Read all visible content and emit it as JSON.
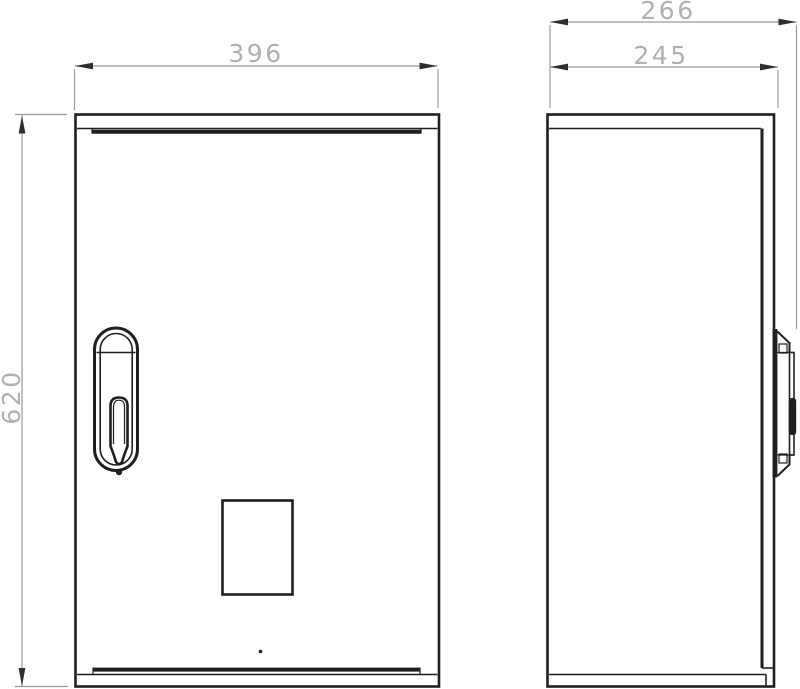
{
  "drawing": {
    "front_view": {
      "width_label": "396",
      "height_label": "620"
    },
    "side_view": {
      "overall_depth_label": "266",
      "body_depth_label": "245"
    }
  },
  "colors": {
    "outline": "#1f1f1f",
    "dimension_line": "#9b9b9b",
    "dimension_text": "#b0b0b0",
    "background": "#ffffff"
  }
}
